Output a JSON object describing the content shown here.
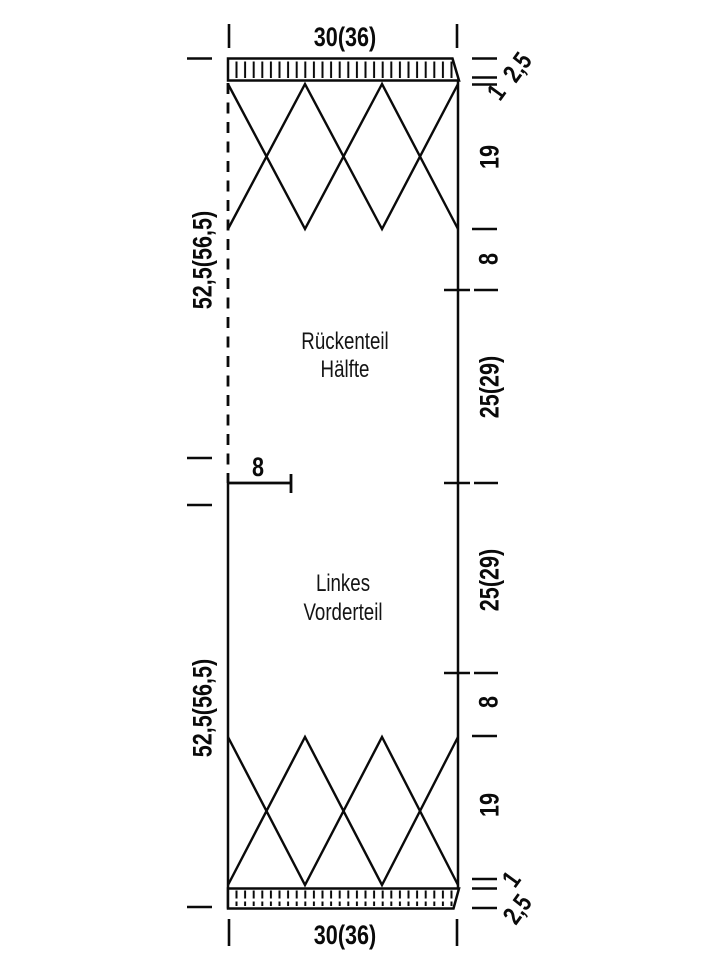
{
  "diagram": {
    "back_piece": {
      "line1": "Rückenteil",
      "line2": "Hälfte"
    },
    "front_piece": {
      "line1": "Linkes",
      "line2": "Vorderteil"
    },
    "top": {
      "width": "30(36)",
      "band": "2,5",
      "roll": "1",
      "pattern": "19",
      "plain": "8",
      "body": "25(29)",
      "total": "52,5(56,5)"
    },
    "middle": {
      "shoulder": "8"
    },
    "bottom": {
      "body": "25(29)",
      "plain": "8",
      "pattern": "19",
      "roll": "1",
      "band": "2,5",
      "total": "52,5(56,5)",
      "width": "30(36)"
    },
    "colors": {
      "line": "#0a0a0a",
      "background": "#ffffff"
    }
  }
}
